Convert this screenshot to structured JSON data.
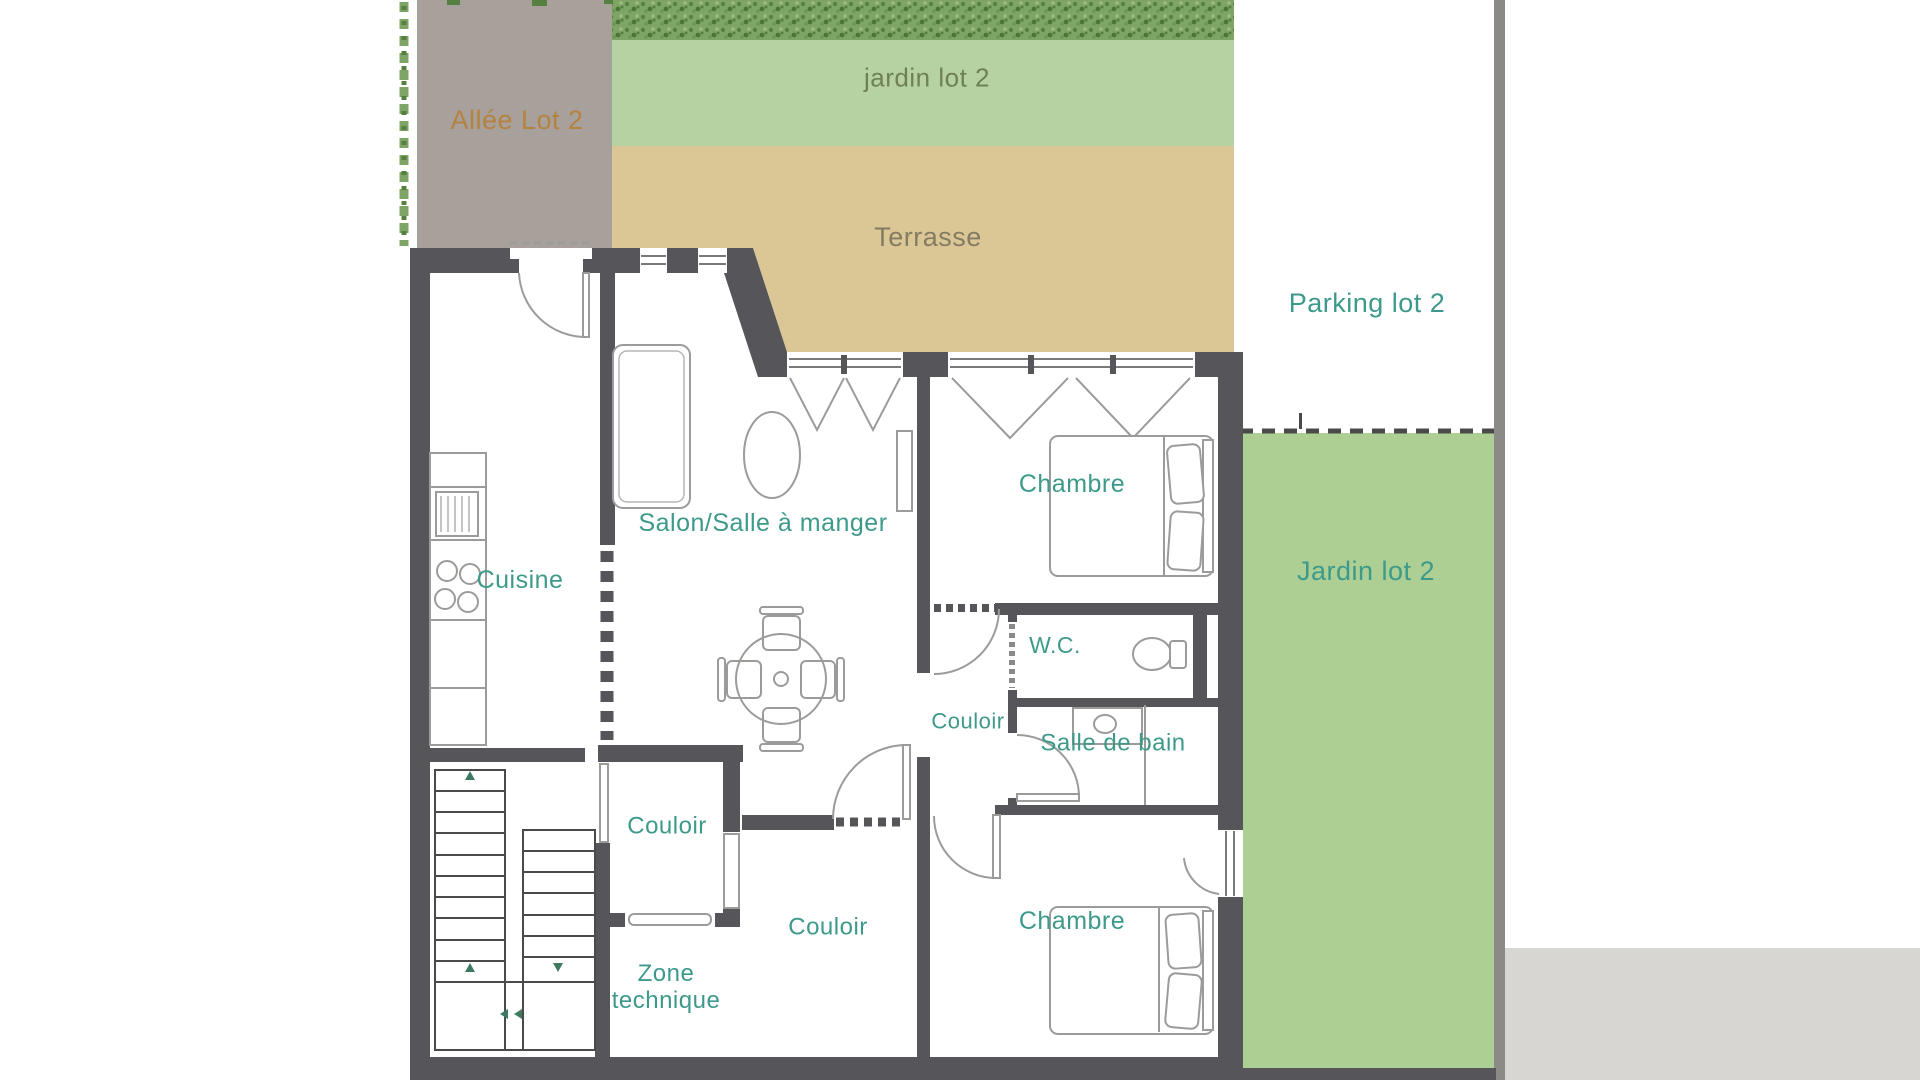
{
  "plan": {
    "labels": {
      "allee": {
        "text": "Allée Lot 2"
      },
      "jardin_top": {
        "text": "jardin lot 2"
      },
      "terrasse": {
        "text": "Terrasse"
      },
      "parking": {
        "text": "Parking lot 2"
      },
      "jardin_right": {
        "text": "Jardin lot 2"
      },
      "salon": {
        "text": "Salon/Salle à manger"
      },
      "cuisine": {
        "text": "Cuisine"
      },
      "chambre1": {
        "text": "Chambre"
      },
      "wc": {
        "text": "W.C."
      },
      "couloir_right": {
        "text": "Couloir"
      },
      "salle_de_bain": {
        "text": "Salle de bain"
      },
      "couloir_upper": {
        "text": "Couloir"
      },
      "couloir_lower": {
        "text": "Couloir"
      },
      "zone_technique": {
        "text": "Zone\ntechnique"
      },
      "chambre2": {
        "text": "Chambre"
      }
    },
    "colors": {
      "teal": "#3d9a8b",
      "orange": "#b5823f",
      "brown": "#847b63",
      "olive": "#6e8054",
      "wall": "#56555a",
      "taupe": "#a8a09b",
      "tan": "#dbc795",
      "green-light": "#b7d2a2",
      "green-mid": "#aecf94",
      "hedge": "#7fa566",
      "hedge-dark": "#55803f",
      "line": "#9b9b99",
      "stair": "#4a4a48",
      "arrow": "#3d7a5f",
      "boundary": "#8b8a87",
      "corner-gray": "#d8d6d3"
    }
  }
}
